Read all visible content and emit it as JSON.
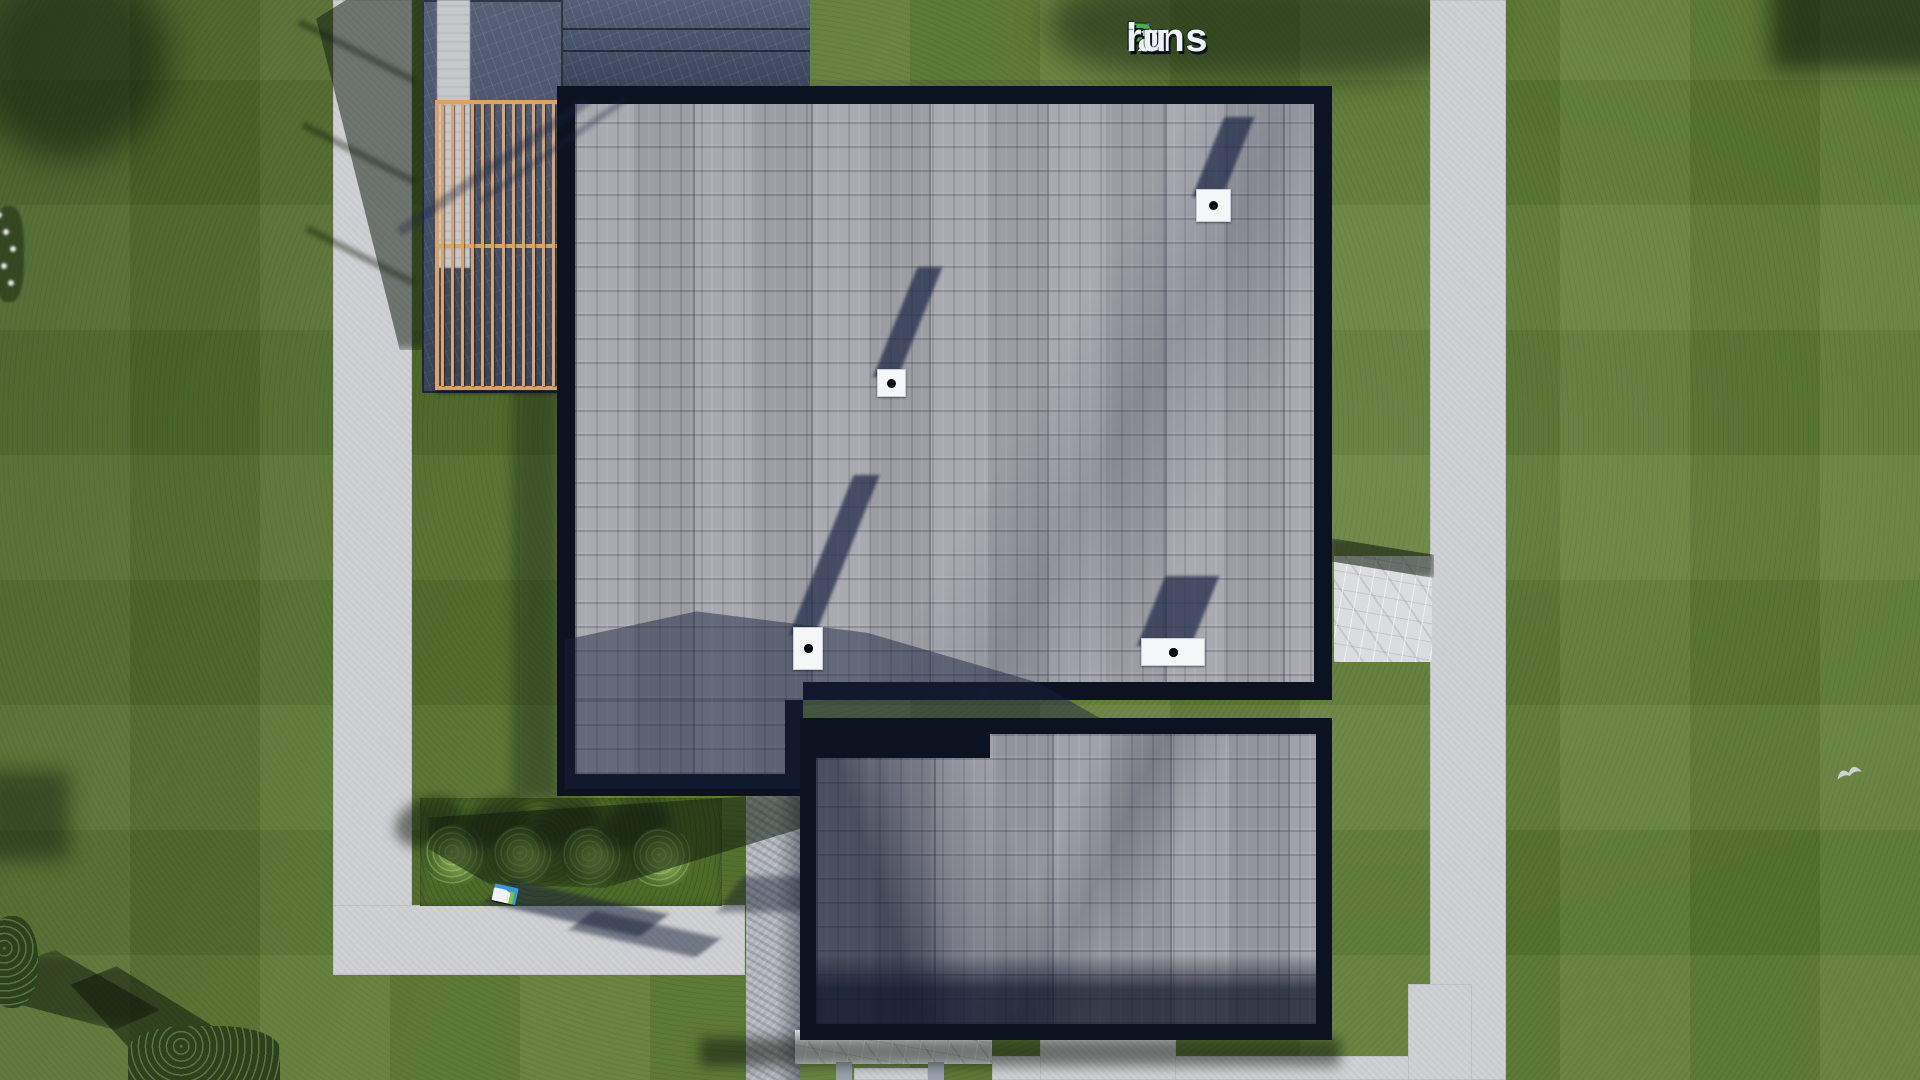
{
  "scene": {
    "title": "Aerial 3D render of a house roof plan",
    "width": 1920,
    "height": 1080
  },
  "branding": {
    "logo": {
      "text": "FixPlans.ru",
      "segments": [
        {
          "text": "F",
          "color": "#3c86d8"
        },
        {
          "text": "ix",
          "color": "#eef1f5"
        },
        {
          "text": "P",
          "color": "#49b14b"
        },
        {
          "text": "lans",
          "color": "#eef1f5"
        },
        {
          "text": ".",
          "color": "#3c86d8"
        },
        {
          "text": "ru",
          "color": "#eef1f5"
        }
      ]
    },
    "ground_watermark": {
      "text": "FixPlans.ru",
      "blocks": [
        {
          "color": "#3a9ad9",
          "w": 24,
          "h": 17
        },
        {
          "color": "#f2f3f5",
          "w": 9,
          "h": 13
        },
        {
          "color": "#f2f3f5",
          "w": 13,
          "h": 13
        },
        {
          "color": "#7ec832",
          "w": 21,
          "h": 12
        },
        {
          "color": "#f2f3f5",
          "w": 13,
          "h": 12
        },
        {
          "color": "#f2f3f5",
          "w": 15,
          "h": 12
        },
        {
          "color": "#f2f3f5",
          "w": 13,
          "h": 11
        },
        {
          "color": "#f2f3f5",
          "w": 17,
          "h": 11
        },
        {
          "color": "#2f9ad0",
          "w": 11,
          "h": 10
        },
        {
          "color": "#f2f3f5",
          "w": 11,
          "h": 10
        },
        {
          "color": "#f2f3f5",
          "w": 15,
          "h": 10
        }
      ]
    }
  },
  "palette": {
    "grass": "#5d7b33",
    "foliage": "#2c421c",
    "path": "#cfd0d3",
    "granite": "#b4b7bd",
    "marble": "#dadcdf",
    "membrane": "#424e68",
    "parapet": "#0c1220",
    "shingle": "#a4a5ab",
    "shingleext": "#9c9da4",
    "wood": "#d8a467",
    "ventwhite": "#f5f6f7",
    "shadownavy": "#1c2744"
  },
  "roof": {
    "vents": [
      {
        "id": "vent-1",
        "x": 1196,
        "y": 189,
        "w": 35,
        "h": 33,
        "dots": 1,
        "shadow_len": 80
      },
      {
        "id": "vent-2",
        "x": 877,
        "y": 369,
        "w": 29,
        "h": 28,
        "dots": 1,
        "shadow_len": 110
      },
      {
        "id": "vent-3",
        "x": 793,
        "y": 627,
        "w": 30,
        "h": 43,
        "dots": 2,
        "shadow_len": 160
      },
      {
        "id": "vent-4",
        "x": 1141,
        "y": 638,
        "w": 64,
        "h": 28,
        "dots": 4,
        "shadow_len": 70
      }
    ]
  },
  "pergola": {
    "slats": 12
  },
  "garden": {
    "bushes": [
      {
        "cx": 455,
        "cy": 855
      },
      {
        "cx": 523,
        "cy": 856
      },
      {
        "cx": 592,
        "cy": 857
      },
      {
        "cx": 662,
        "cy": 858
      }
    ],
    "bush_radius": 31,
    "bird": {
      "x": 1834,
      "y": 762
    },
    "flower_dots": 5
  }
}
